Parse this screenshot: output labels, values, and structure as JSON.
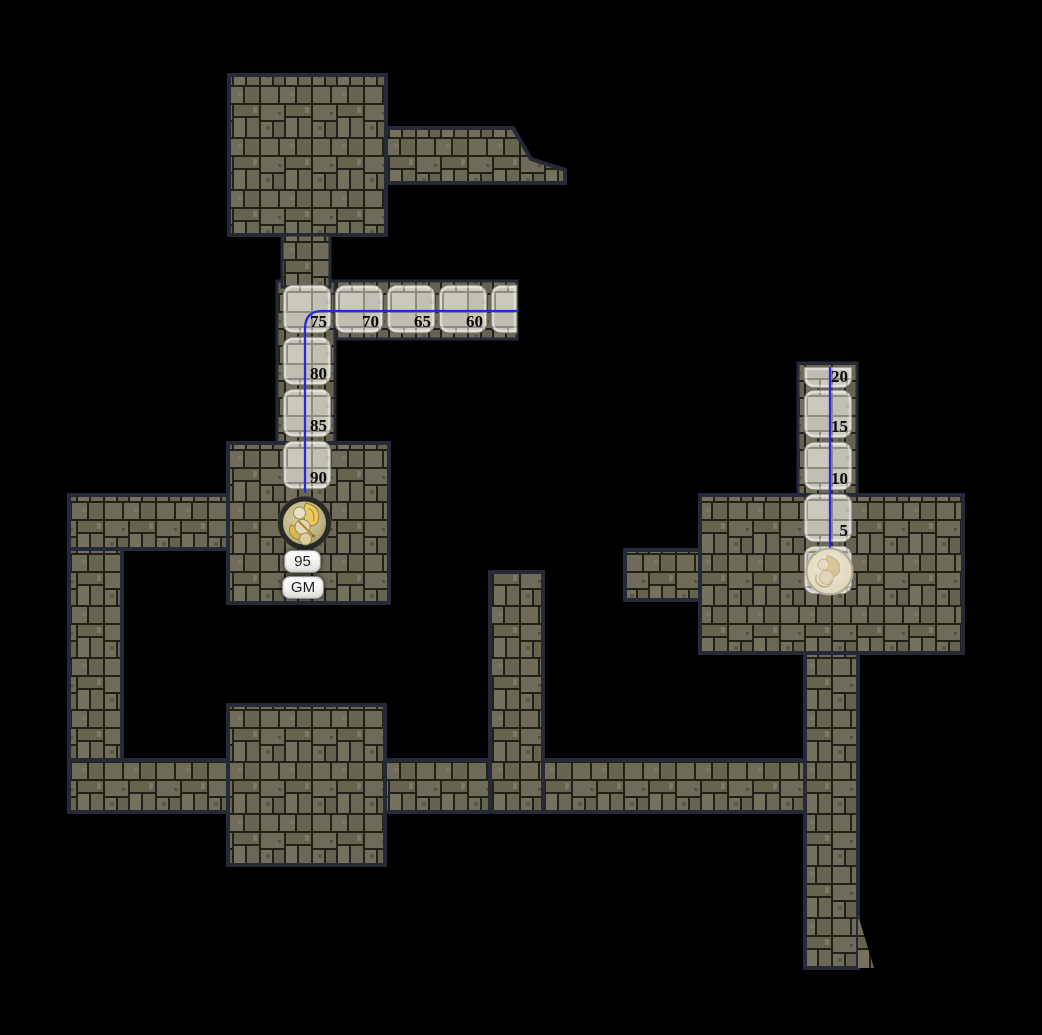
{
  "scene": {
    "app_context": "virtual-tabletop dungeon map with token movement measurement",
    "background_color": "#000000"
  },
  "palette": {
    "stone_dark_base": "#6e6c59",
    "stone_dark_mortar": "#21211a",
    "stone_light_base": "#c8c5bb",
    "stone_light_mortar": "#8f8c7f",
    "region_border": "#262a38",
    "path_cell_stroke": "#6f6c60",
    "path_cell_highlight": "rgba(255,255,255,0.42)",
    "movement_line_color": "#2828dc",
    "distance_label_color": "#0a0a0a"
  },
  "movement": {
    "line_width": 2.3,
    "lines": [
      {
        "name": "left-path-line",
        "d": "M 517 311 L 322 311 Q 305 311 305 329 L 305 493"
      },
      {
        "name": "right-path-line",
        "d": "M 830 367 L 830 551"
      }
    ],
    "left_path_cells": [
      {
        "x": 283,
        "y": 285,
        "label": "75"
      },
      {
        "x": 335,
        "y": 285,
        "label": "70"
      },
      {
        "x": 387,
        "y": 285,
        "label": "65"
      },
      {
        "x": 439,
        "y": 285,
        "label": "60"
      },
      {
        "x": 491,
        "y": 285,
        "w": 26,
        "flat": "right",
        "label": ""
      },
      {
        "x": 283,
        "y": 337,
        "label": "80"
      },
      {
        "x": 283,
        "y": 389,
        "label": "85"
      },
      {
        "x": 283,
        "y": 441,
        "label": "90"
      }
    ],
    "right_path_cells": [
      {
        "x": 804,
        "y": 367,
        "h": 21,
        "flat": "top",
        "label": "20"
      },
      {
        "x": 804,
        "y": 390,
        "label": "15"
      },
      {
        "x": 804,
        "y": 442,
        "label": "10"
      },
      {
        "x": 804,
        "y": 494,
        "label": "5"
      },
      {
        "x": 804,
        "y": 546,
        "ghost": true,
        "label": ""
      }
    ]
  },
  "gm_token": {
    "distance_label": "95",
    "name_label": "GM"
  }
}
